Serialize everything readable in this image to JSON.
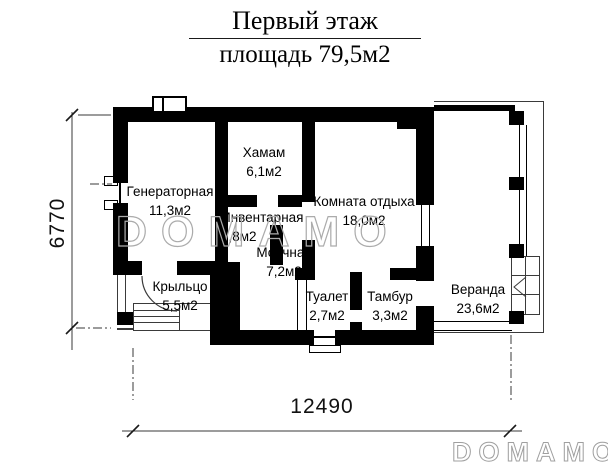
{
  "title": {
    "line1": "Первый этаж",
    "line2": "площадь 79,5м2"
  },
  "rooms": {
    "generator": {
      "name": "Генераторная",
      "area": "11,3м2"
    },
    "hamam": {
      "name": "Хамам",
      "area": "6,1м2"
    },
    "lounge": {
      "name": "Комната отдыха",
      "area": "18,0м2"
    },
    "veranda": {
      "name": "Веранда",
      "area": "23,6м2"
    },
    "storage": {
      "name": "Инвентарная",
      "area": "1,8м2"
    },
    "washroom": {
      "name": "Моечная",
      "area": "7,2м2"
    },
    "porch": {
      "name": "Крыльцо",
      "area": "5,5м2"
    },
    "toilet": {
      "name": "Туалет",
      "area": "2,7м2"
    },
    "vestibule": {
      "name": "Тамбур",
      "area": "3,3м2"
    }
  },
  "dimensions": {
    "horizontal": "12490",
    "vertical": "6770"
  },
  "watermarks": {
    "center": "DOMAMO",
    "corner": "DOMAMO"
  },
  "colors": {
    "wall": "#000000",
    "line": "#3a3a3a",
    "watermark": "#ababab"
  }
}
